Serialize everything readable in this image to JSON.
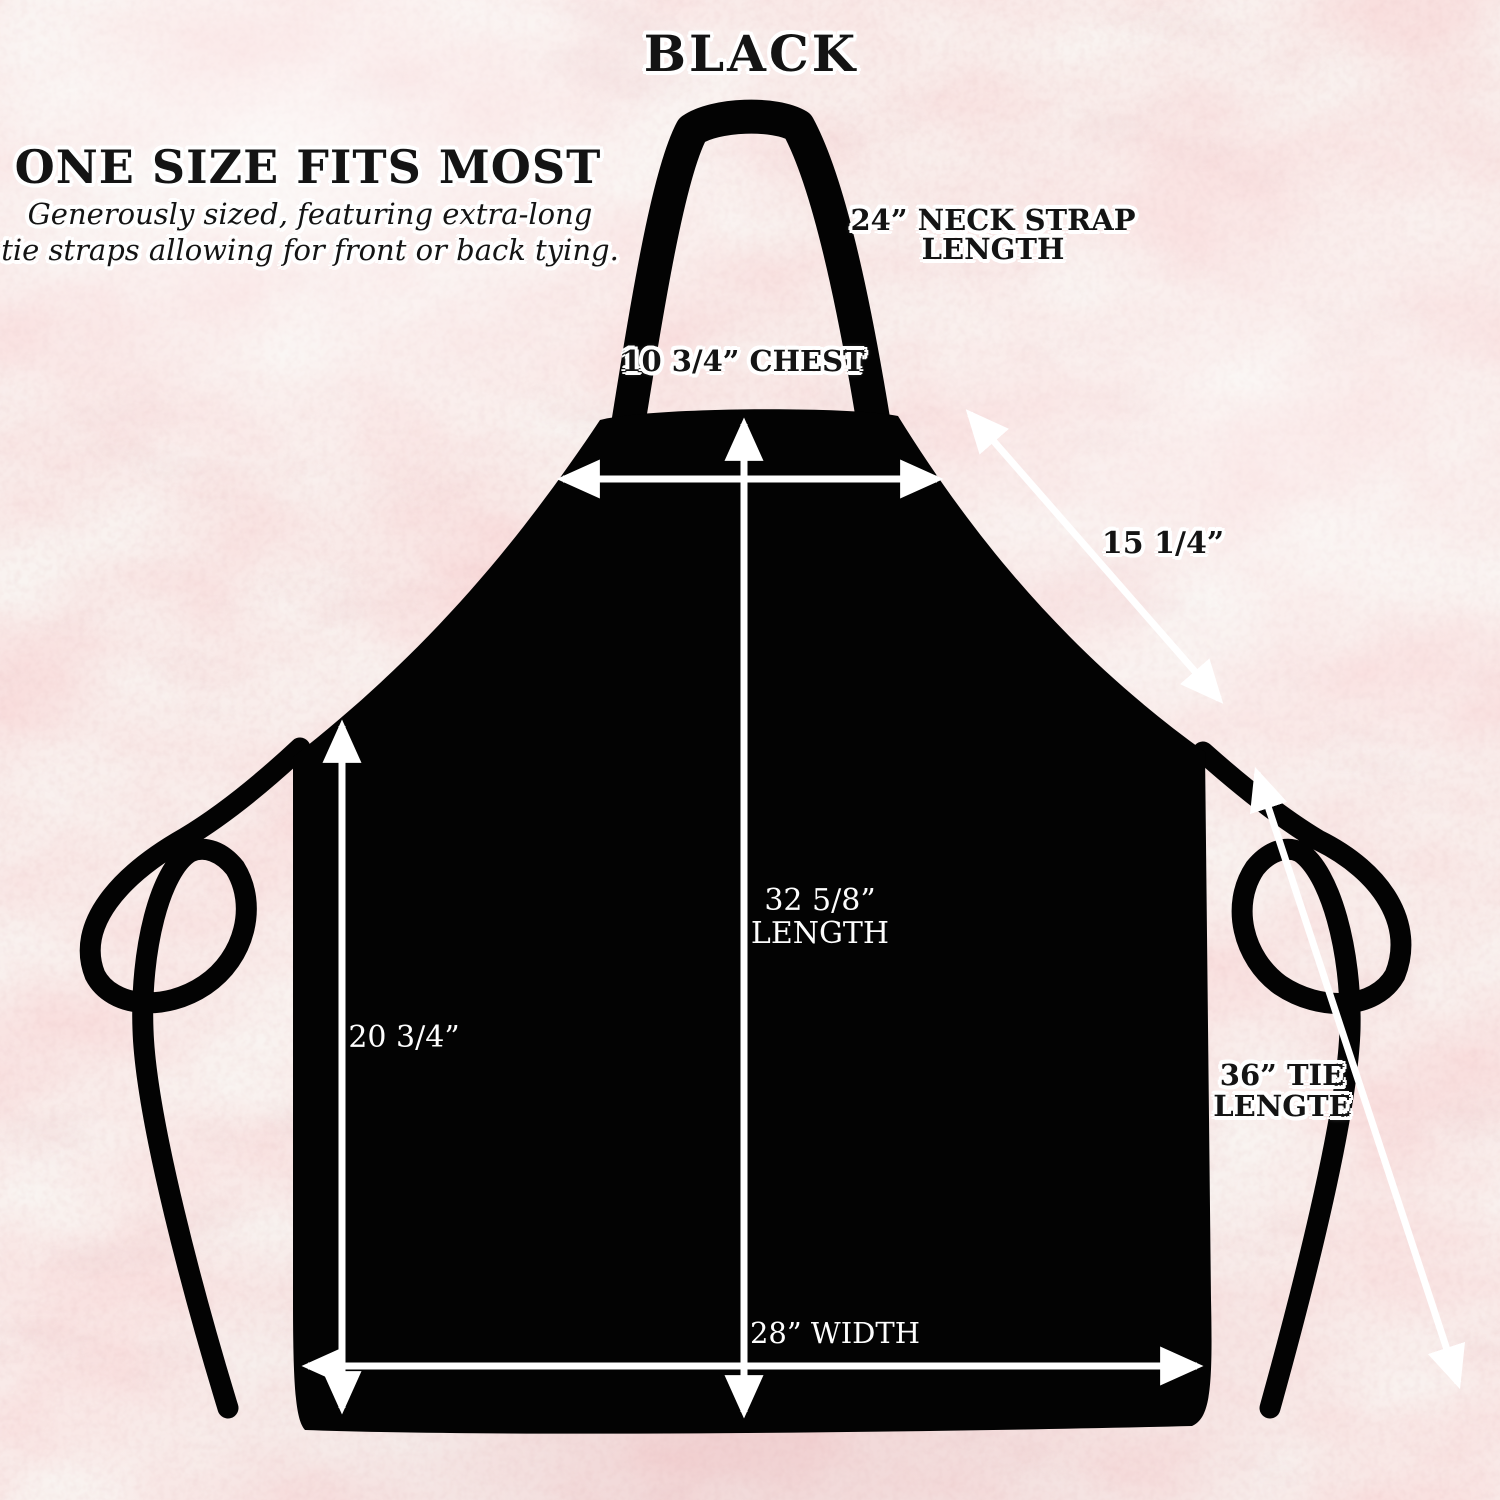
{
  "title": "BLACK",
  "size_info": {
    "heading": "ONE SIZE FITS MOST",
    "subtitle_line1": "Generously sized, featuring extra-long",
    "subtitle_line2": "tie straps allowing for front or back tying."
  },
  "measurements": {
    "neck_strap": {
      "line1": "24” NECK STRAP",
      "line2": "LENGTH"
    },
    "chest": "10 3/4” CHEST",
    "shoulder_diagonal": "15 1/4”",
    "length": {
      "line1": "32 5/8”",
      "line2": "LENGTH"
    },
    "side_length": "20 3/4”",
    "tie": {
      "line1": "36” TIE",
      "line2": "LENGTE"
    },
    "width": "28” WIDTH"
  },
  "colors": {
    "apron": "#000000",
    "arrows": "#ffffff",
    "label_text": "#141414",
    "label_halo": "#ffffff",
    "marble_base": "#f2e2e2",
    "marble_vein": "#c79296"
  }
}
